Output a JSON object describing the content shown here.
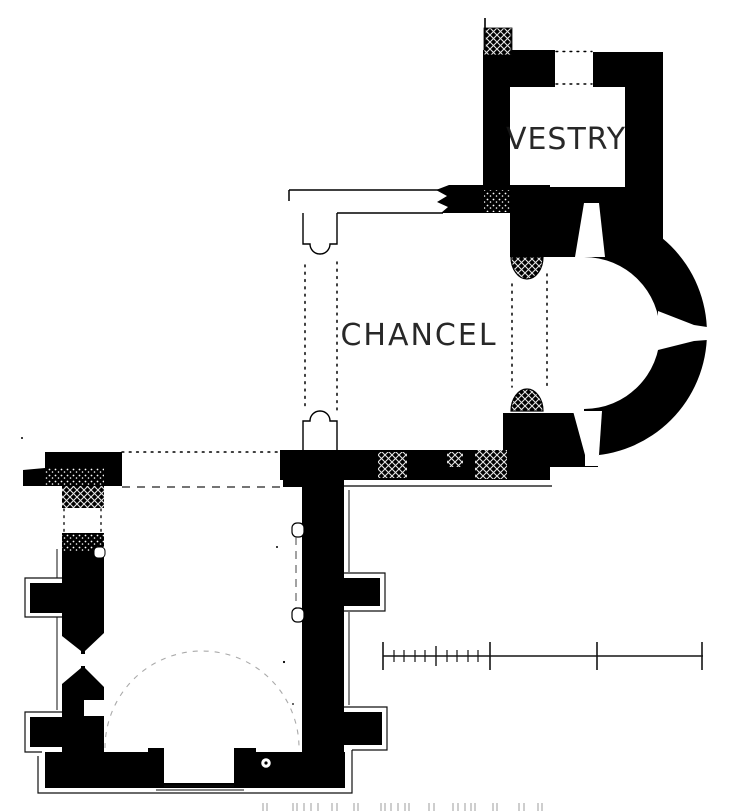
{
  "plan": {
    "canvas": {
      "w": 736,
      "h": 812
    },
    "bg": "#ffffff",
    "ink": "#000000",
    "labels": {
      "vestry": "VESTRY",
      "chancel": "CHANCEL"
    },
    "shapes": [
      {
        "t": "rect",
        "n": "nave-west-wall",
        "x": 62,
        "y": 453,
        "w": 42,
        "h": 307,
        "f": "#000000"
      },
      {
        "t": "rect",
        "n": "nave-east-wall",
        "x": 302,
        "y": 453,
        "w": 42,
        "h": 302,
        "f": "#000000"
      },
      {
        "t": "rect",
        "n": "nave-northeast-corner",
        "x": 283,
        "y": 452,
        "w": 61,
        "h": 35,
        "f": "#000000"
      },
      {
        "t": "rect",
        "n": "nave-south-wall",
        "x": 45,
        "y": 752,
        "w": 300,
        "h": 36,
        "f": "#000000"
      },
      {
        "t": "poly",
        "n": "northwest-wall-fragment",
        "p": "45,452 122,452 122,486 104,486 104,508 62,508 62,486 23,486 23,470 45,468",
        "f": "#000000"
      },
      {
        "t": "rect",
        "n": "buttress-west-1",
        "x": 30,
        "y": 583,
        "w": 34,
        "h": 30,
        "f": "#000000"
      },
      {
        "t": "rect",
        "n": "buttress-west-2",
        "x": 30,
        "y": 717,
        "w": 34,
        "h": 30,
        "f": "#000000"
      },
      {
        "t": "rect",
        "n": "buttress-east-1",
        "x": 344,
        "y": 578,
        "w": 36,
        "h": 28,
        "f": "#000000"
      },
      {
        "t": "rect",
        "n": "buttress-east-2",
        "x": 344,
        "y": 712,
        "w": 38,
        "h": 33,
        "f": "#000000"
      },
      {
        "t": "rect",
        "n": "door-jamb-west",
        "x": 148,
        "y": 748,
        "w": 16,
        "h": 37,
        "f": "#000000"
      },
      {
        "t": "rect",
        "n": "door-jamb-east",
        "x": 234,
        "y": 748,
        "w": 22,
        "h": 37,
        "f": "#000000"
      },
      {
        "t": "poly",
        "n": "chancel-north-wall-broken-end",
        "p": "449,185 483,185 483,213 441,213 448,207 437,202 447,196 436,190",
        "f": "#000000"
      },
      {
        "t": "rect",
        "n": "chancel-north-wall-east",
        "x": 483,
        "y": 185,
        "w": 67,
        "h": 28,
        "f": "#000000"
      },
      {
        "t": "rect",
        "n": "apse-north-pier",
        "x": 510,
        "y": 213,
        "w": 40,
        "h": 44,
        "f": "#000000"
      },
      {
        "t": "rect",
        "n": "chancel-south-wall",
        "x": 280,
        "y": 450,
        "w": 270,
        "h": 30,
        "f": "#000000"
      },
      {
        "t": "rect",
        "n": "apse-south-pier",
        "x": 503,
        "y": 413,
        "w": 95,
        "h": 54,
        "f": "#000000"
      },
      {
        "t": "rect",
        "n": "vestry-west-wall",
        "x": 483,
        "y": 53,
        "w": 27,
        "h": 160,
        "f": "#000000"
      },
      {
        "t": "rect",
        "n": "vestry-north-wall-west",
        "x": 483,
        "y": 50,
        "w": 72,
        "h": 37,
        "f": "#000000"
      },
      {
        "t": "rect",
        "n": "vestry-north-wall-east",
        "x": 593,
        "y": 52,
        "w": 70,
        "h": 35,
        "f": "#000000"
      },
      {
        "t": "rect",
        "n": "vestry-east-wall",
        "x": 625,
        "y": 52,
        "w": 38,
        "h": 186,
        "f": "#000000"
      },
      {
        "t": "rect",
        "n": "vestry-south-wall",
        "x": 510,
        "y": 187,
        "w": 153,
        "h": 70,
        "f": "#000000"
      },
      {
        "t": "path",
        "n": "apse-wall",
        "d": "M584,210 A123,123 0 0 1 584,456 L584,409 A76,76 0 0 0 584,257 Z",
        "f": "#000000"
      },
      {
        "t": "rect",
        "n": "masonry-hatch-northwest",
        "x": 62,
        "y": 484,
        "w": 42,
        "h": 24,
        "f": "xhatch"
      },
      {
        "t": "rect",
        "n": "masonry-stipple-northwest",
        "x": 45,
        "y": 468,
        "w": 59,
        "h": 18,
        "f": "stipple"
      },
      {
        "t": "rect",
        "n": "masonry-stipple-west",
        "x": 62,
        "y": 533,
        "w": 42,
        "h": 19,
        "f": "stipple"
      },
      {
        "t": "rect",
        "n": "repair-hatch-1",
        "x": 378,
        "y": 452,
        "w": 29,
        "h": 26,
        "f": "xhatch"
      },
      {
        "t": "rect",
        "n": "repair-hatch-2",
        "x": 447,
        "y": 452,
        "w": 16,
        "h": 15,
        "f": "xhatch"
      },
      {
        "t": "rect",
        "n": "repair-hatch-3",
        "x": 475,
        "y": 450,
        "w": 32,
        "h": 29,
        "f": "xhatch"
      },
      {
        "t": "rect",
        "n": "masonry-stipple-vestry",
        "x": 484,
        "y": 190,
        "w": 26,
        "h": 22,
        "f": "stipple"
      },
      {
        "t": "path",
        "n": "apse-respond-north",
        "d": "M511,257 A16,22 0 0 0 543,257 Z",
        "f": "xhatch",
        "s": "#000000",
        "sw": 1.2
      },
      {
        "t": "path",
        "n": "apse-respond-south",
        "d": "M511,411 A16,22 0 0 1 543,411 Z",
        "f": "xhatch",
        "s": "#000000",
        "sw": 1.2
      },
      {
        "t": "rect",
        "n": "wall-stub-hatch",
        "x": 484,
        "y": 28,
        "w": 28,
        "h": 27,
        "f": "xhatch",
        "s": "#000000",
        "sw": 0.8
      },
      {
        "t": "rect",
        "n": "west-doorway-gap",
        "x": 61,
        "y": 508,
        "w": 44,
        "h": 25,
        "f": "#ffffff"
      },
      {
        "t": "poly",
        "n": "west-window-outer-splay",
        "p": "62,636 81,651 81,668 62,684",
        "f": "#ffffff"
      },
      {
        "t": "poly",
        "n": "west-window-inner-splay",
        "p": "104,633 85,651 85,668 104,687",
        "f": "#ffffff"
      },
      {
        "t": "rect",
        "n": "west-window-slit",
        "x": 79,
        "y": 654,
        "w": 8,
        "h": 12,
        "f": "#ffffff"
      },
      {
        "t": "rect",
        "n": "wall-recess",
        "x": 84,
        "y": 700,
        "w": 20,
        "h": 16,
        "f": "#ffffff"
      },
      {
        "t": "rect",
        "n": "south-doorway",
        "x": 164,
        "y": 752,
        "w": 70,
        "h": 31,
        "f": "#ffffff"
      },
      {
        "t": "poly",
        "n": "vestry-doorway-splay",
        "p": "575,257 584,203 599,203 605,257",
        "f": "#ffffff"
      },
      {
        "t": "poly",
        "n": "apse-east-window",
        "p": "658,311 694,325 707,327 707,340 694,341 658,350",
        "f": "#ffffff"
      },
      {
        "t": "poly",
        "n": "apse-south-window",
        "p": "573,411 585,455 599,455 602,411",
        "f": "#ffffff"
      },
      {
        "t": "rect",
        "n": "apse-south-window-mouth",
        "x": 585,
        "y": 453,
        "w": 13,
        "h": 13,
        "f": "#ffffff"
      },
      {
        "t": "rect",
        "n": "blocked-arch-jamb-north",
        "x": 292,
        "y": 523,
        "w": 12,
        "h": 14,
        "rx": 5,
        "f": "#ffffff",
        "s": "#000000",
        "sw": 1.2
      },
      {
        "t": "rect",
        "n": "blocked-arch-jamb-south",
        "x": 292,
        "y": 608,
        "w": 12,
        "h": 14,
        "rx": 5,
        "f": "#ffffff",
        "s": "#000000",
        "sw": 1.2
      },
      {
        "t": "rect",
        "n": "blocked-jamb-west",
        "x": 94,
        "y": 547,
        "w": 11,
        "h": 11,
        "rx": 4,
        "f": "#ffffff",
        "s": "#000000",
        "sw": 1
      },
      {
        "t": "circle",
        "n": "font-basin",
        "cx": 266,
        "cy": 763,
        "r": 5.5,
        "f": "#ffffff",
        "s": "#000000",
        "sw": 1.5
      },
      {
        "t": "circle",
        "n": "font-center-dot",
        "cx": 266,
        "cy": 763,
        "r": 1.6,
        "f": "#000000"
      },
      {
        "t": "line",
        "n": "wall-stub-line",
        "x1": 485,
        "y1": 18,
        "x2": 485,
        "y2": 50,
        "s": "#000000",
        "sw": 1.6
      },
      {
        "t": "line",
        "n": "wall-stub-line-2",
        "x1": 511,
        "y1": 30,
        "x2": 511,
        "y2": 52,
        "s": "#000000",
        "sw": 1
      },
      {
        "t": "line",
        "n": "vestry-door-dotted-north",
        "x1": 556,
        "y1": 51.5,
        "x2": 592,
        "y2": 51.5,
        "s": "#000000",
        "sw": 1.4,
        "sd": "1.8 5.2",
        "cap": "round"
      },
      {
        "t": "line",
        "n": "vestry-door-dotted-south",
        "x1": 556,
        "y1": 84,
        "x2": 592,
        "y2": 84,
        "s": "#000000",
        "sw": 1.4,
        "sd": "1.8 5.2",
        "cap": "round"
      },
      {
        "t": "line",
        "n": "destroyed-north-wall-outer",
        "x1": 289,
        "y1": 190,
        "x2": 443,
        "y2": 190,
        "s": "#000000",
        "sw": 1.5
      },
      {
        "t": "line",
        "n": "destroyed-north-wall-inner",
        "x1": 337,
        "y1": 213,
        "x2": 443,
        "y2": 213,
        "s": "#000000",
        "sw": 1.5
      },
      {
        "t": "line",
        "n": "destroyed-north-wall-end",
        "x1": 289,
        "y1": 190,
        "x2": 289,
        "y2": 201,
        "s": "#000000",
        "sw": 1.5
      },
      {
        "t": "path",
        "n": "chancel-respond-northwest",
        "d": "M303,213 L303,244 L310,244 A10,10 0 0 0 330,244 L337,244 L337,213",
        "f": "none",
        "s": "#000000",
        "sw": 1.4
      },
      {
        "t": "path",
        "n": "chancel-respond-southwest",
        "d": "M303,450 L303,421 L310,421 A10,10 0 0 1 330,421 L337,421 L337,450",
        "f": "none",
        "s": "#000000",
        "sw": 1.4
      },
      {
        "t": "line",
        "n": "chancel-arch-dotted-west-1",
        "x1": 305,
        "y1": 265,
        "x2": 305,
        "y2": 410,
        "s": "#000000",
        "sw": 1.5,
        "sd": "1.8 5.5",
        "cap": "round"
      },
      {
        "t": "line",
        "n": "chancel-arch-dotted-west-2",
        "x1": 337,
        "y1": 262,
        "x2": 337,
        "y2": 410,
        "s": "#000000",
        "sw": 1.5,
        "sd": "1.8 5.5",
        "cap": "round"
      },
      {
        "t": "line",
        "n": "apse-arch-dotted-1",
        "x1": 512,
        "y1": 284,
        "x2": 512,
        "y2": 387,
        "s": "#000000",
        "sw": 1.5,
        "sd": "1.8 5.5",
        "cap": "round"
      },
      {
        "t": "line",
        "n": "apse-arch-dotted-2",
        "x1": 547,
        "y1": 274,
        "x2": 547,
        "y2": 390,
        "s": "#000000",
        "sw": 1.5,
        "sd": "1.8 5.5",
        "cap": "round"
      },
      {
        "t": "line",
        "n": "south-wall-face-line",
        "x1": 303,
        "y1": 486,
        "x2": 552,
        "y2": 486,
        "s": "#000000",
        "sw": 1.2
      },
      {
        "t": "line",
        "n": "nave-north-dotted",
        "x1": 122,
        "y1": 452,
        "x2": 283,
        "y2": 452,
        "s": "#000000",
        "sw": 1.5,
        "sd": "1.8 5.5",
        "cap": "round"
      },
      {
        "t": "line",
        "n": "nave-north-dashed",
        "x1": 122,
        "y1": 487,
        "x2": 283,
        "y2": 487,
        "s": "#222222",
        "sw": 1.3,
        "sd": "8 7"
      },
      {
        "t": "line",
        "n": "blocked-arch-dashed",
        "x1": 296,
        "y1": 537,
        "x2": 296,
        "y2": 608,
        "s": "#444444",
        "sw": 1,
        "sd": "8 6"
      },
      {
        "t": "path",
        "n": "former-apse-arc",
        "d": "M105,748 A97,97 0 0 1 299,748",
        "f": "none",
        "s": "#aaaaaa",
        "sw": 1.1,
        "sd": "5 6"
      },
      {
        "t": "line",
        "n": "west-door-dotted-1",
        "x1": 64,
        "y1": 509,
        "x2": 64,
        "y2": 532,
        "s": "#000000",
        "sw": 1.3,
        "sd": "1.8 5",
        "cap": "round"
      },
      {
        "t": "line",
        "n": "west-door-dotted-2",
        "x1": 101,
        "y1": 509,
        "x2": 101,
        "y2": 532,
        "s": "#000000",
        "sw": 1.3,
        "sd": "1.8 5",
        "cap": "round"
      },
      {
        "t": "path",
        "n": "buttress-outline-west-1",
        "d": "M62,578 L25,578 L25,617 L62,617",
        "f": "none",
        "s": "#111111",
        "sw": 1.2
      },
      {
        "t": "path",
        "n": "buttress-outline-west-2",
        "d": "M62,712 L25,712 L25,752 L42,752",
        "f": "none",
        "s": "#111111",
        "sw": 1.2
      },
      {
        "t": "path",
        "n": "buttress-outline-east-1",
        "d": "M344,573 L385,573 L385,611 L344,611",
        "f": "none",
        "s": "#111111",
        "sw": 1.2
      },
      {
        "t": "path",
        "n": "buttress-outline-east-2",
        "d": "M344,707 L387,707 L387,750 L352,750",
        "f": "none",
        "s": "#111111",
        "sw": 1.2
      },
      {
        "t": "path",
        "n": "plinth-outline",
        "d": "M352,750 L352,793 L38,793 L38,756",
        "f": "none",
        "s": "#111111",
        "sw": 1.2
      },
      {
        "t": "line",
        "n": "wall-face-line-west-1",
        "x1": 57,
        "y1": 549,
        "x2": 57,
        "y2": 578,
        "s": "#111111",
        "sw": 1
      },
      {
        "t": "line",
        "n": "wall-face-line-west-2",
        "x1": 57,
        "y1": 617,
        "x2": 57,
        "y2": 710,
        "s": "#111111",
        "sw": 1
      },
      {
        "t": "line",
        "n": "wall-face-line-east-1",
        "x1": 349,
        "y1": 490,
        "x2": 349,
        "y2": 572,
        "s": "#111111",
        "sw": 1
      },
      {
        "t": "line",
        "n": "wall-face-line-east-2",
        "x1": 349,
        "y1": 612,
        "x2": 349,
        "y2": 705,
        "s": "#111111",
        "sw": 1
      },
      {
        "t": "line",
        "n": "door-sill-inner",
        "x1": 164,
        "y1": 786,
        "x2": 234,
        "y2": 786,
        "s": "#111111",
        "sw": 1.1
      },
      {
        "t": "line",
        "n": "door-sill-outer",
        "x1": 156,
        "y1": 790,
        "x2": 244,
        "y2": 790,
        "s": "#111111",
        "sw": 1
      },
      {
        "t": "circle",
        "n": "ink-speck-1",
        "cx": 277,
        "cy": 547,
        "r": 1,
        "f": "#000000"
      },
      {
        "t": "circle",
        "n": "ink-speck-2",
        "cx": 284,
        "cy": 662,
        "r": 1.1,
        "f": "#000000"
      },
      {
        "t": "circle",
        "n": "ink-speck-3",
        "cx": 293,
        "cy": 704,
        "r": 0.9,
        "f": "#000000"
      },
      {
        "t": "circle",
        "n": "ink-speck-4",
        "cx": 22,
        "cy": 438,
        "r": 1,
        "f": "#000000"
      }
    ],
    "scale_bar": {
      "y": 656,
      "x1": 383,
      "x2": 703,
      "stroke": "#151515",
      "major_ticks": [
        383,
        490,
        597,
        702
      ],
      "medium_ticks": [
        436
      ],
      "minor_ticks": [
        394,
        404,
        415,
        425,
        447,
        457,
        468,
        478
      ],
      "major_half": 14,
      "medium_half": 10,
      "minor_half": 6
    },
    "caption_marks": {
      "y1": 803,
      "y2": 811,
      "color": "#a6a6a6",
      "xs": [
        263,
        267,
        293,
        297,
        304,
        311,
        318,
        332,
        337,
        354,
        358,
        381,
        385,
        391,
        398,
        405,
        409,
        429,
        434,
        453,
        458,
        465,
        471,
        475,
        493,
        497,
        519,
        524,
        538,
        542
      ]
    }
  }
}
